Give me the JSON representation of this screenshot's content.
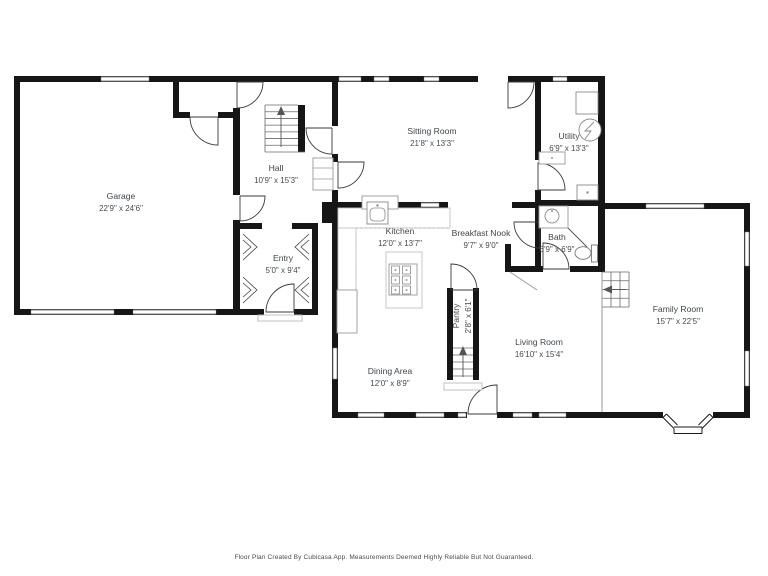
{
  "rooms": {
    "garage": {
      "name": "Garage",
      "dims": "22'9\" x 24'6\""
    },
    "hall": {
      "name": "Hall",
      "dims": "10'9\" x 15'3\""
    },
    "sitting_room": {
      "name": "Sitting Room",
      "dims": "21'8\" x 13'3\""
    },
    "utility": {
      "name": "Utility",
      "dims": "6'9\" x 13'3\""
    },
    "kitchen": {
      "name": "Kitchen",
      "dims": "12'0\" x 13'7\""
    },
    "breakfast_nook": {
      "name": "Breakfast Nook",
      "dims": "9'7\" x 9'0\""
    },
    "bath": {
      "name": "Bath",
      "dims": "6'9\" x 6'9\""
    },
    "entry": {
      "name": "Entry",
      "dims": "5'0\" x 9'4\""
    },
    "family_room": {
      "name": "Family Room",
      "dims": "15'7\" x 22'5\""
    },
    "pantry": {
      "name": "Pantry",
      "dims": "2'8\" x 6'1\""
    },
    "living_room": {
      "name": "Living Room",
      "dims": "16'10\" x 15'4\""
    },
    "dining_area": {
      "name": "Dining Area",
      "dims": "12'0\" x 8'9\""
    }
  },
  "footer": {
    "text": "Floor Plan Created By Cubicasa App. Measurements Deemed Highly Reliable But Not Guaranteed."
  }
}
